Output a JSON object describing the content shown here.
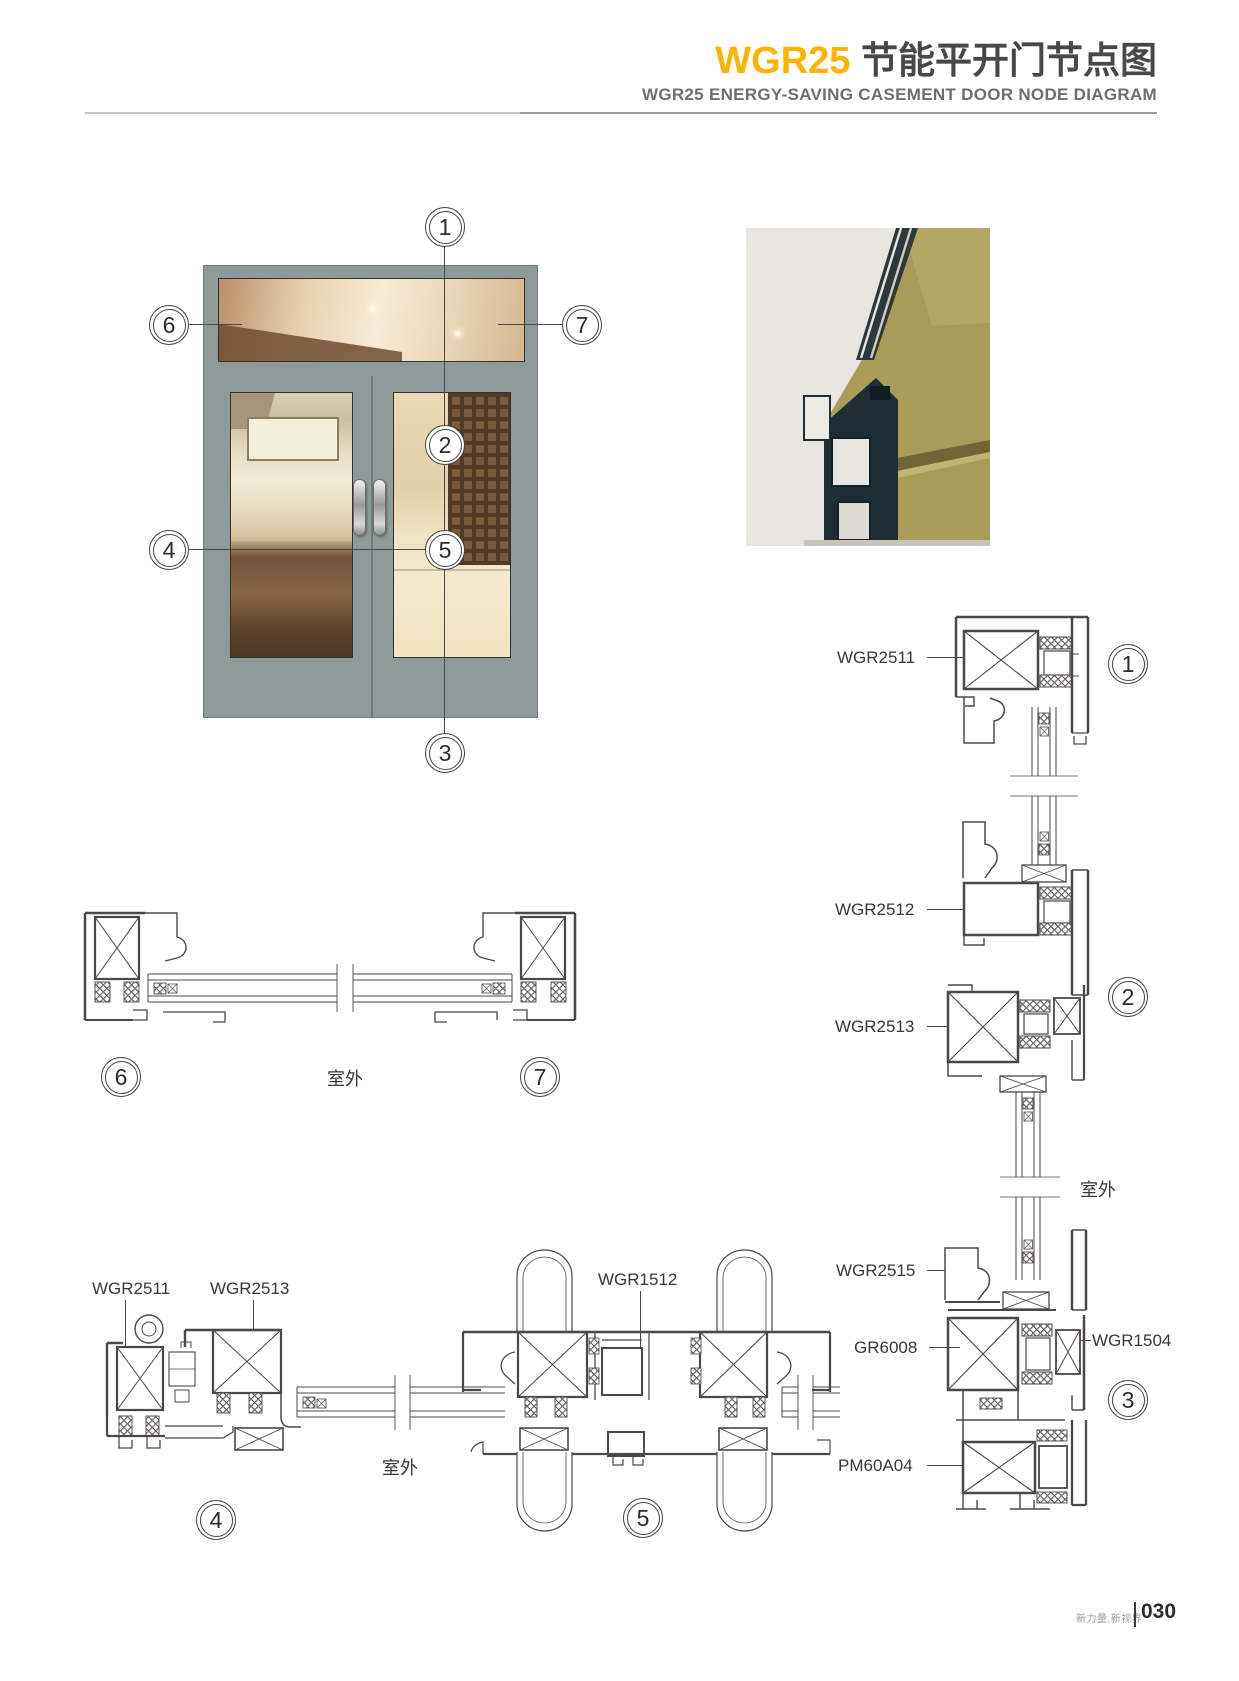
{
  "header": {
    "model": "WGR25",
    "title_cn": "节能平开门节点图",
    "subtitle_en": "WGR25 ENERGY-SAVING CASEMENT DOOR NODE DIAGRAM"
  },
  "callouts": {
    "n1": "1",
    "n2": "2",
    "n3": "3",
    "n4": "4",
    "n5": "5",
    "n6": "6",
    "n7": "7"
  },
  "part_labels": {
    "head_frame": "WGR2511",
    "transom_bottom": "WGR2512",
    "door_top": "WGR2513",
    "outdoor": "室外",
    "door_bottom": "WGR2515",
    "threshold": "GR6008",
    "glazing_bead": "WGR1504",
    "base_profile": "PM60A04",
    "hinge_frame": "WGR2511",
    "hinge_leaf": "WGR2513",
    "meeting_stile": "WGR1512"
  },
  "footer": {
    "brand": "新力量,新视界",
    "page": "030"
  },
  "colors": {
    "accent": "#ffb300",
    "title_gray": "#4a4747",
    "line_art": "#4b4846",
    "door_frame_gray": "#8d9a99",
    "render_olive": "#a89c58",
    "render_bg": "#e9e6e1"
  }
}
